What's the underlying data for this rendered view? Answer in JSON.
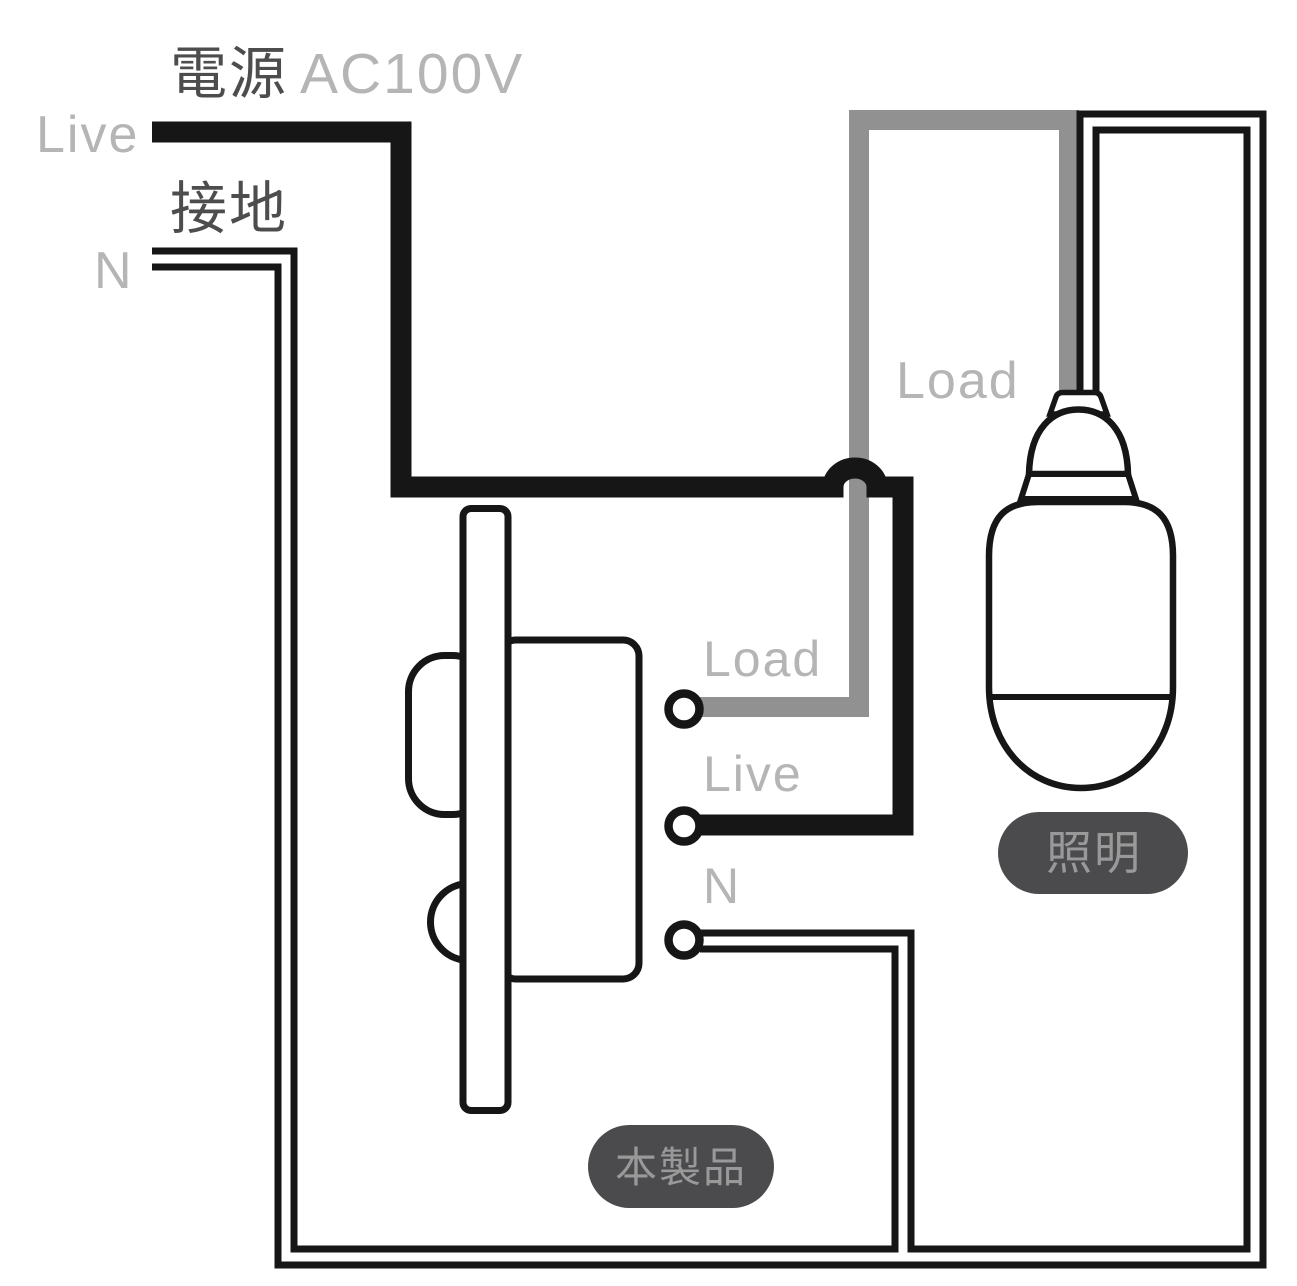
{
  "diagram": {
    "power": {
      "title_jp": "電源",
      "voltage": "AC100V",
      "live_label": "Live",
      "ground_label_jp": "接地",
      "neutral_label": "N"
    },
    "device": {
      "terminal_load_label": "Load",
      "terminal_live_label": "Live",
      "terminal_neutral_label": "N",
      "product_badge": "本製品"
    },
    "lamp": {
      "load_wire_label": "Load",
      "lighting_badge": "照明"
    }
  },
  "colors": {
    "background": "#ffffff",
    "wire_black": "#161616",
    "wire_gray": "#919191",
    "label_light_gray": "#b5b5b5",
    "label_dark_gray": "#4d4d4d",
    "badge_bg": "#4b4b4e",
    "badge_text": "#999999"
  }
}
